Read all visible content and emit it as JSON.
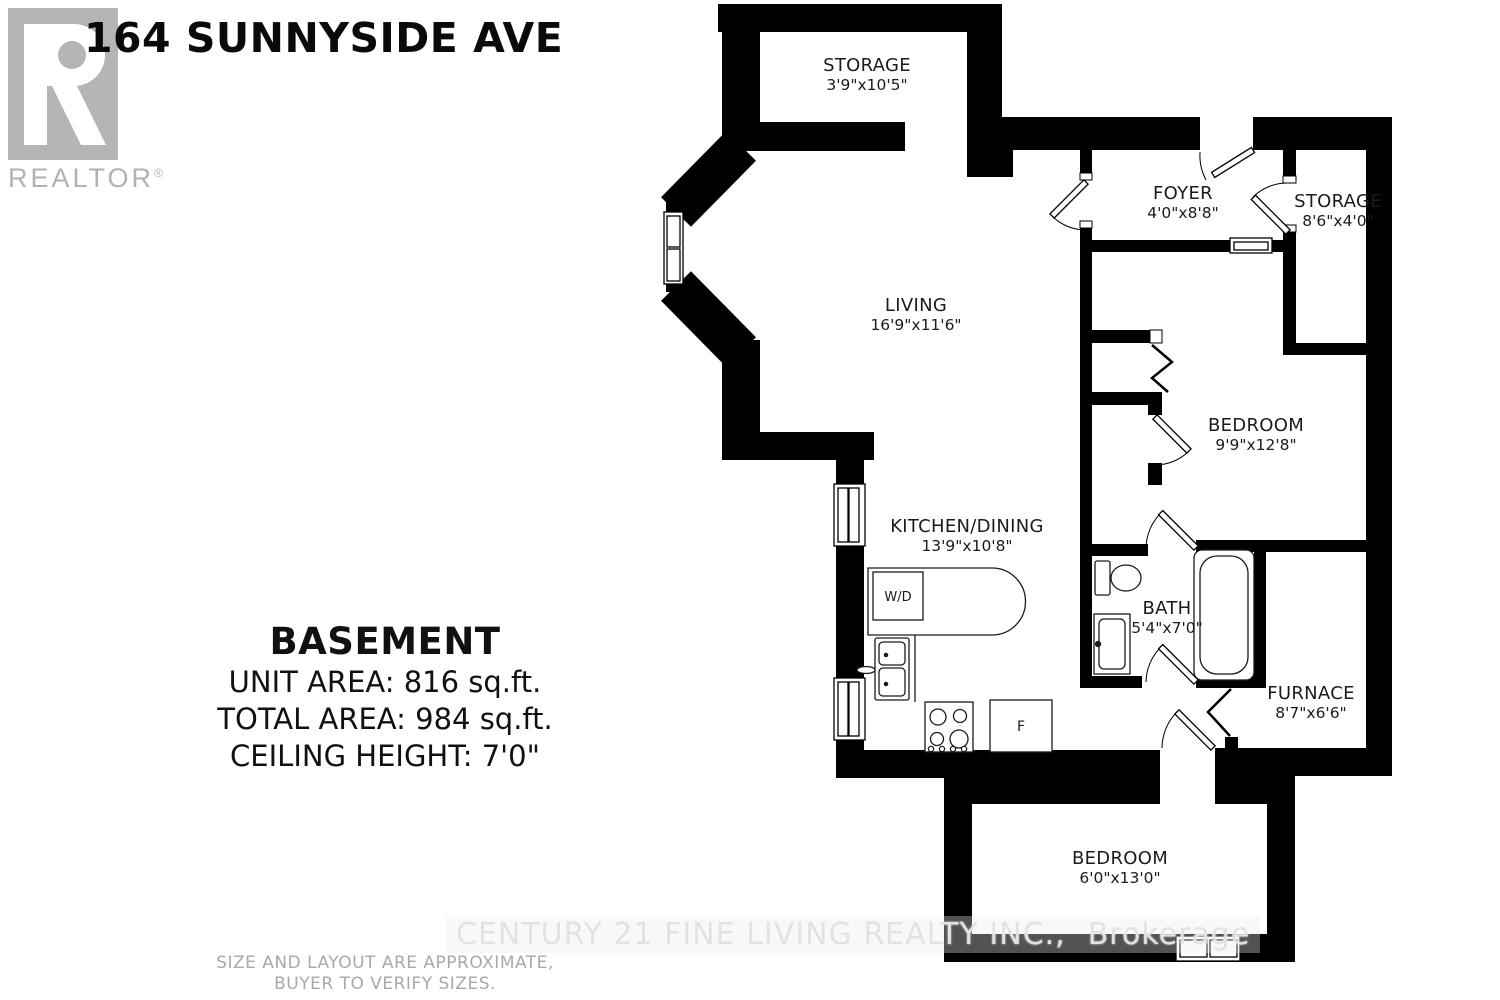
{
  "header": {
    "title": "164 SUNNYSIDE AVE"
  },
  "logo": {
    "letter": "R",
    "wordmark": "REALTOR",
    "registered": "®"
  },
  "summary": {
    "title": "BASEMENT",
    "unit_area": "UNIT AREA: 816 sq.ft.",
    "total_area": "TOTAL AREA: 984 sq.ft.",
    "ceiling_height": "CEILING HEIGHT: 7'0\""
  },
  "rooms": {
    "storage_top": {
      "name": "STORAGE",
      "dims": "3'9\"x10'5\""
    },
    "foyer": {
      "name": "FOYER",
      "dims": "4'0\"x8'8\""
    },
    "storage_right": {
      "name": "STORAGE",
      "dims": "8'6\"x4'0\""
    },
    "living": {
      "name": "LIVING",
      "dims": "16'9\"x11'6\""
    },
    "bedroom_main": {
      "name": "BEDROOM",
      "dims": "9'9\"x12'8\""
    },
    "kitchen": {
      "name": "KITCHEN/DINING",
      "dims": "13'9\"x10'8\""
    },
    "bath": {
      "name": "BATH",
      "dims": "5'4\"x7'0\""
    },
    "furnace": {
      "name": "FURNACE",
      "dims": "8'7\"x6'6\""
    },
    "bedroom_lower": {
      "name": "BEDROOM",
      "dims": "6'0\"x13'0\""
    }
  },
  "fixtures": {
    "washer_dryer": "W/D",
    "fridge": "F"
  },
  "watermark": {
    "brand": "CENTURY 21 FINE LIVING REALTY INC.,",
    "suffix": "Brokerage"
  },
  "footer": {
    "line1": "SIZE AND LAYOUT ARE APPROXIMATE,",
    "line2": "BUYER TO VERIFY SIZES."
  },
  "colors": {
    "wall": "#000000",
    "logo_gray": "#b5b5b5",
    "watermark_gray": "#e2e2e2",
    "footer_gray": "#a9a9a9"
  }
}
